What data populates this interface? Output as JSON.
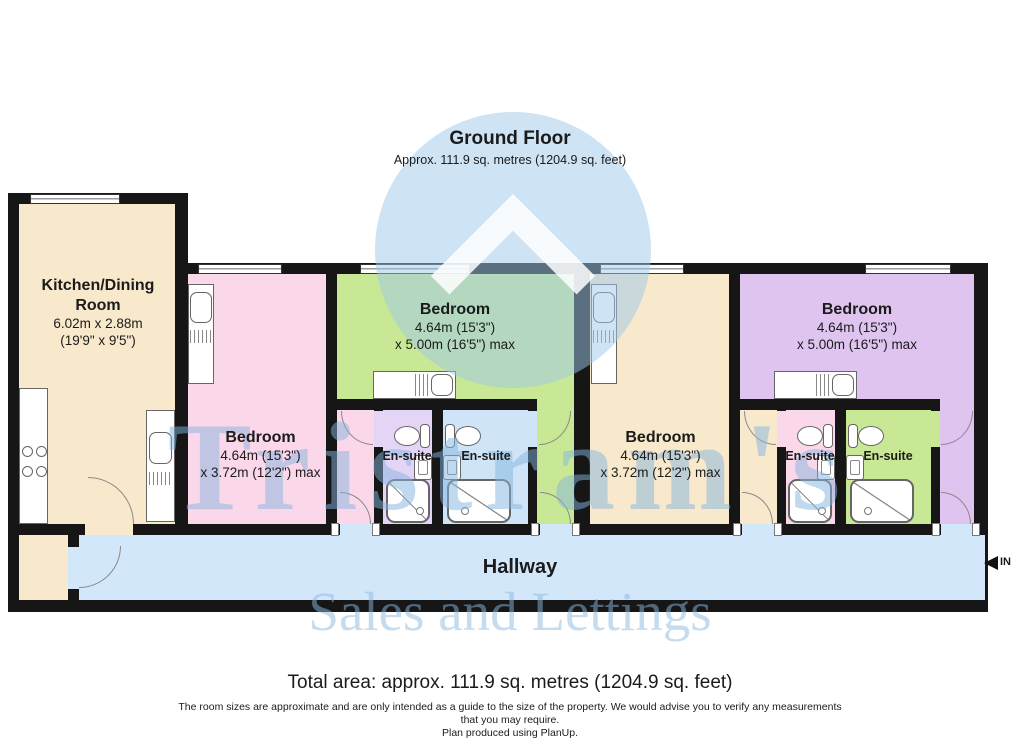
{
  "title": {
    "heading": "Ground Floor",
    "subtitle": "Approx. 111.9 sq. metres (1204.9 sq. feet)"
  },
  "rooms": {
    "kitchen": {
      "name": "Kitchen/Dining Room",
      "line1": "6.02m x 2.88m",
      "line2": "(19'9\" x 9'5\")"
    },
    "bedroom_pink": {
      "name": "Bedroom",
      "line1": "4.64m (15'3\")",
      "line2": "x 3.72m (12'2\") max"
    },
    "bedroom_green": {
      "name": "Bedroom",
      "line1": "4.64m (15'3\")",
      "line2": "x 5.00m (16'5\") max"
    },
    "bedroom_tan": {
      "name": "Bedroom",
      "line1": "4.64m (15'3\")",
      "line2": "x 3.72m (12'2\") max"
    },
    "bedroom_purple": {
      "name": "Bedroom",
      "line1": "4.64m (15'3\")",
      "line2": "x 5.00m (16'5\") max"
    },
    "ensuite_a": {
      "name": "En-suite"
    },
    "ensuite_b": {
      "name": "En-suite"
    },
    "ensuite_c": {
      "name": "En-suite"
    },
    "ensuite_d": {
      "name": "En-suite"
    },
    "hallway": {
      "name": "Hallway"
    }
  },
  "entry": {
    "label": "IN"
  },
  "watermark": {
    "line1": "Tristram's",
    "line2": "Sales and Lettings"
  },
  "footer": {
    "total": "Total area: approx. 111.9 sq. metres (1204.9 sq. feet)",
    "disclaimer1": "The room sizes are approximate and are only intended as a guide to the size of the property. We would advise you to verify any measurements",
    "disclaimer2": "that you may require.",
    "disclaimer3": "Plan produced using PlanUp."
  },
  "colors": {
    "wall": "#161616",
    "kitchen": "#f9e9cc",
    "bedroom_pink": "#fad7e9",
    "bedroom_green": "#c9e895",
    "bedroom_purple": "#e0c4f0",
    "ensuite_lavender": "#e4d4f6",
    "ensuite_blue": "#cfe4f7",
    "hallway": "#d2e7f9",
    "watermark_blue": "#9ec7e9"
  }
}
